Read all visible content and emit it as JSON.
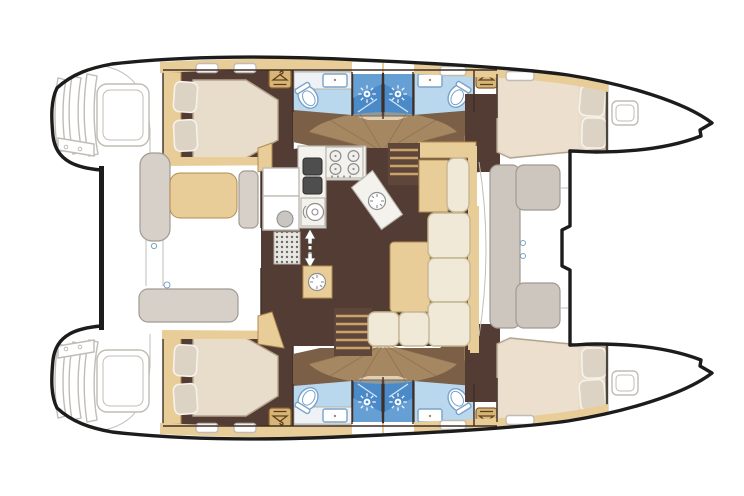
{
  "diagram": {
    "kind": "catamaran-deck-plan",
    "view": "top-down floor plan, bows pointing right, no text labels"
  },
  "colors": {
    "outline_black": "#1c1c1c",
    "wall_brown": "#3f2e26",
    "floor_dark": "#533c34",
    "floor_corridor": "#7b5f46",
    "fan_tan": "#c9a878",
    "fan_line": "#8a6a48",
    "wood_tan": "#e8cd98",
    "wood_trim": "#b08c50",
    "bed_cream": "#e8ddca",
    "bed_light": "#ecdfce",
    "bed_border": "#b3a28c",
    "pillow": "#ddd3c4",
    "sofa_cream": "#f1e9d7",
    "sofa_trim": "#c6b694",
    "bath_blue": "#b9d8ee",
    "bath_stroke": "#79a3c9",
    "shower_blue": "#4a8ac8",
    "counter_white": "#f4f2ed",
    "counter_stroke": "#b5b1aa",
    "dark_sink": "#4e4e4e",
    "gray_fixture": "#8e8e8e",
    "bench_gray": "#d6d0c9",
    "bench_stroke": "#a19a92",
    "seat_gray": "#cdc6be",
    "line_gray": "#c2beb7",
    "hatch_stroke": "#c0bcb5",
    "door_tan": "#d8b576",
    "door_stroke": "#82602e",
    "hanger_dark": "#5a4020",
    "stairs_bg": "#5e463a",
    "step_line": "#caa26a"
  },
  "icons": [
    "hanger-icon",
    "shower-head-icon",
    "stove-burner-icon",
    "vent-fan-icon",
    "companionway-arrow-icon",
    "deck-hatch-icon"
  ],
  "features": {
    "hulls": [
      {
        "name": "port-hull",
        "rooms": [
          "aft-double-cabin",
          "head-with-toilet-and-sink",
          "shower-stall",
          "shower-stall",
          "head-with-toilet-and-sink",
          "forward-double-cabin"
        ],
        "details": [
          "transom-steps",
          "engine-hatch",
          "wardrobe-doors: 2",
          "pillows: 4",
          "deck-hatches"
        ]
      },
      {
        "name": "starboard-hull",
        "rooms": [
          "aft-double-cabin",
          "head-with-toilet-and-sink",
          "shower-stall",
          "shower-stall",
          "head-with-toilet-and-sink",
          "forward-double-cabin"
        ],
        "details": [
          "transom-steps",
          "engine-hatch",
          "wardrobe-doors: 2",
          "pillows: 4",
          "deck-hatches"
        ]
      }
    ],
    "bridgedeck": {
      "cockpit": [
        "cockpit-table",
        "side-bench",
        "side-bench",
        "aft-bench",
        "transom-platform"
      ],
      "salon": [
        "galley-counter",
        "stove-4-burners",
        "double-sink",
        "fridge-cabinets",
        "salon-table",
        "l-shaped-sofa",
        "chaise-seat",
        "mast-cabinet",
        "entry-mat",
        "companionway-stairs: 2",
        "companionway-arrow"
      ],
      "foredeck": [
        "forward-seat",
        "deck-hatches: 2",
        "trampoline-area"
      ]
    },
    "counts": {
      "cabins": 4,
      "toilets": 4,
      "showers": 4,
      "sinks_heads": 4
    }
  }
}
